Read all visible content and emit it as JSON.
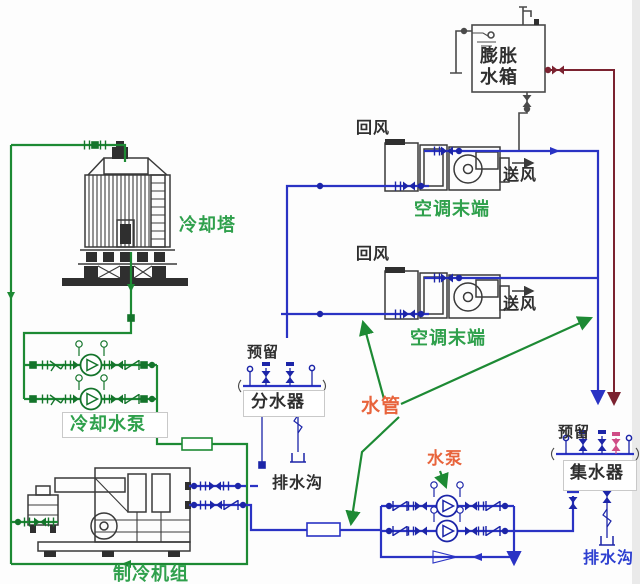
{
  "diagram": {
    "type": "hvac-chilled-and-cooling-water-system-schematic",
    "labels": {
      "cooling_tower": "冷却塔",
      "cooling_water_pump": "冷却水泵",
      "chiller_unit": "制冷机组",
      "ahu_1": "空调末端",
      "ahu_2": "空调末端",
      "expansion_tank_line1": "膨胀",
      "expansion_tank_line2": "水箱",
      "return_air_1": "回风",
      "return_air_2": "回风",
      "supply_air_1": "送风",
      "supply_air_2": "送风",
      "reserved_left": "预留",
      "reserved_right": "预留",
      "distributor": "分水器",
      "collector": "集水器",
      "water_pipe": "水管",
      "chilled_water_pump": "水泵",
      "drain_left": "排水沟",
      "drain_right": "排水沟"
    },
    "colors": {
      "cooling_water_pipe": "#1d8a34",
      "chilled_water_pipe": "#2a33c4",
      "expansion_pipe": "#7b2230",
      "equipment_line": "#3a3a3a",
      "green_label": "#2fa04c",
      "orange_label": "#e8643c",
      "blue_label": "#2d3fd0",
      "dark_label": "#2f2f2f",
      "reserved_pink_valve": "#cf4d86"
    }
  }
}
